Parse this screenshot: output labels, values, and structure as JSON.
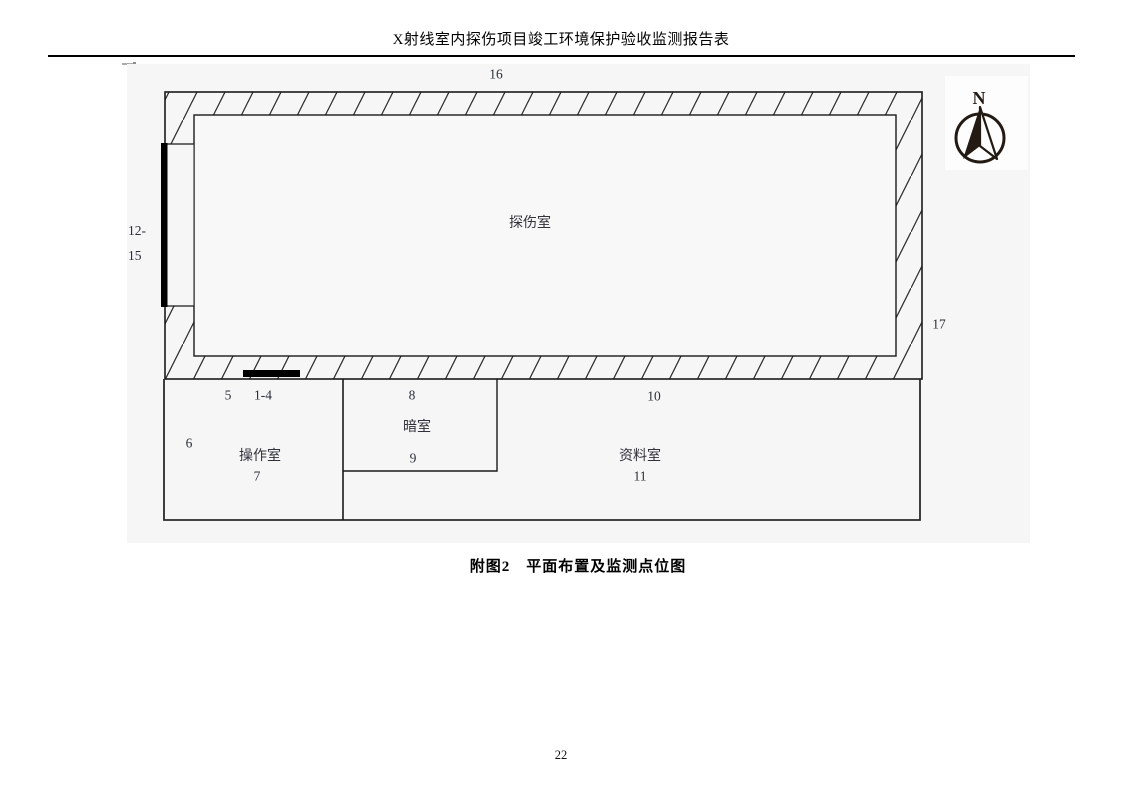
{
  "header": {
    "title": "X射线室内探伤项目竣工环境保护验收监测报告表"
  },
  "figure": {
    "detection_room_label": "探伤室",
    "operation_room_label": "操作室",
    "operation_room_number": "7",
    "darkroom_label": "暗室",
    "darkroom_number_top": "8",
    "darkroom_number_bottom": "9",
    "dataroom_label": "资料室",
    "dataroom_number_top": "10",
    "dataroom_number_bottom": "11",
    "monitor_point_top": "16",
    "monitor_point_right": "17",
    "monitor_point_left_line1": "12-",
    "monitor_point_left_line2": "15",
    "monitor_point_5": "5",
    "monitor_point_1_4": "1-4",
    "monitor_point_6": "6",
    "compass_north": "N"
  },
  "caption": {
    "text": "附图2　平面布置及监测点位图"
  },
  "footer": {
    "page_number": "22"
  },
  "colors": {
    "figure_background": "#f6f6f6",
    "wall_line": "#1f1f1f",
    "label_text": "#2c2f3a",
    "door_bar": "#000000"
  }
}
